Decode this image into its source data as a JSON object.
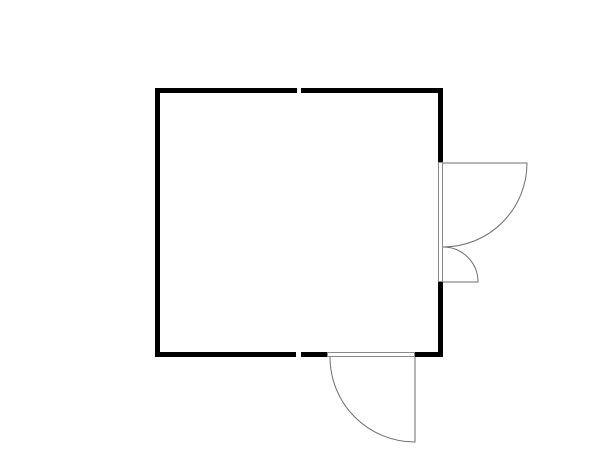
{
  "plan": {
    "kind": "floor-plan",
    "room": {
      "outer_x": 155,
      "outer_y": 88,
      "outer_width": 288,
      "outer_height": 269,
      "wall_thickness_px": 5
    },
    "wall_breaks": [
      {
        "wall": "top",
        "from_x": 297,
        "to_x": 301
      },
      {
        "wall": "bottom",
        "from_x": 296,
        "to_x": 301
      }
    ],
    "doors": [
      {
        "id": "right-unequal-double-door",
        "wall": "right",
        "opening_from_y": 162,
        "opening_to_y": 282,
        "swing": "outward-right",
        "leaves": [
          {
            "hinge": "top",
            "hinge_point": [
              443,
              163
            ],
            "leaf_length": 84
          },
          {
            "hinge": "bottom",
            "hinge_point": [
              443,
              282
            ],
            "leaf_length": 35
          }
        ]
      },
      {
        "id": "bottom-single-door",
        "wall": "bottom",
        "opening_from_x": 327,
        "opening_to_x": 415,
        "swing": "outward-down",
        "hinge_point": [
          415,
          357
        ],
        "leaf_length": 85
      }
    ]
  },
  "colors": {
    "background": "#ffffff",
    "wall": "#000000",
    "door_line": "#6e6e6e",
    "frame_stroke": "#8a8a8a",
    "frame_fill": "#ffffff"
  },
  "paths": {
    "walls": "M155 88H297V93H155Z M301 88H443V93H301Z M155 93H160V352H155Z M438 93H443V162H438Z M438 282H443V352H438Z M155 352H296V357H155Z M301 352H327V357H301Z M415 352H443V357H415Z",
    "right_door_frame": "M438.5 162.5H442.5V281.5H438.5Z",
    "right_door_leaf_large": "M443 163H527A84 84 0 0 1 443 247",
    "right_door_leaf_small": "M443 282H478A35 35 0 0 0 443 247",
    "bottom_door_frame": "M327.5 352.5H414.5V356.5H327.5Z",
    "bottom_door_leaf": "M415 357V442A85 85 0 0 1 330 357"
  },
  "viewbox": "0 0 600 450"
}
